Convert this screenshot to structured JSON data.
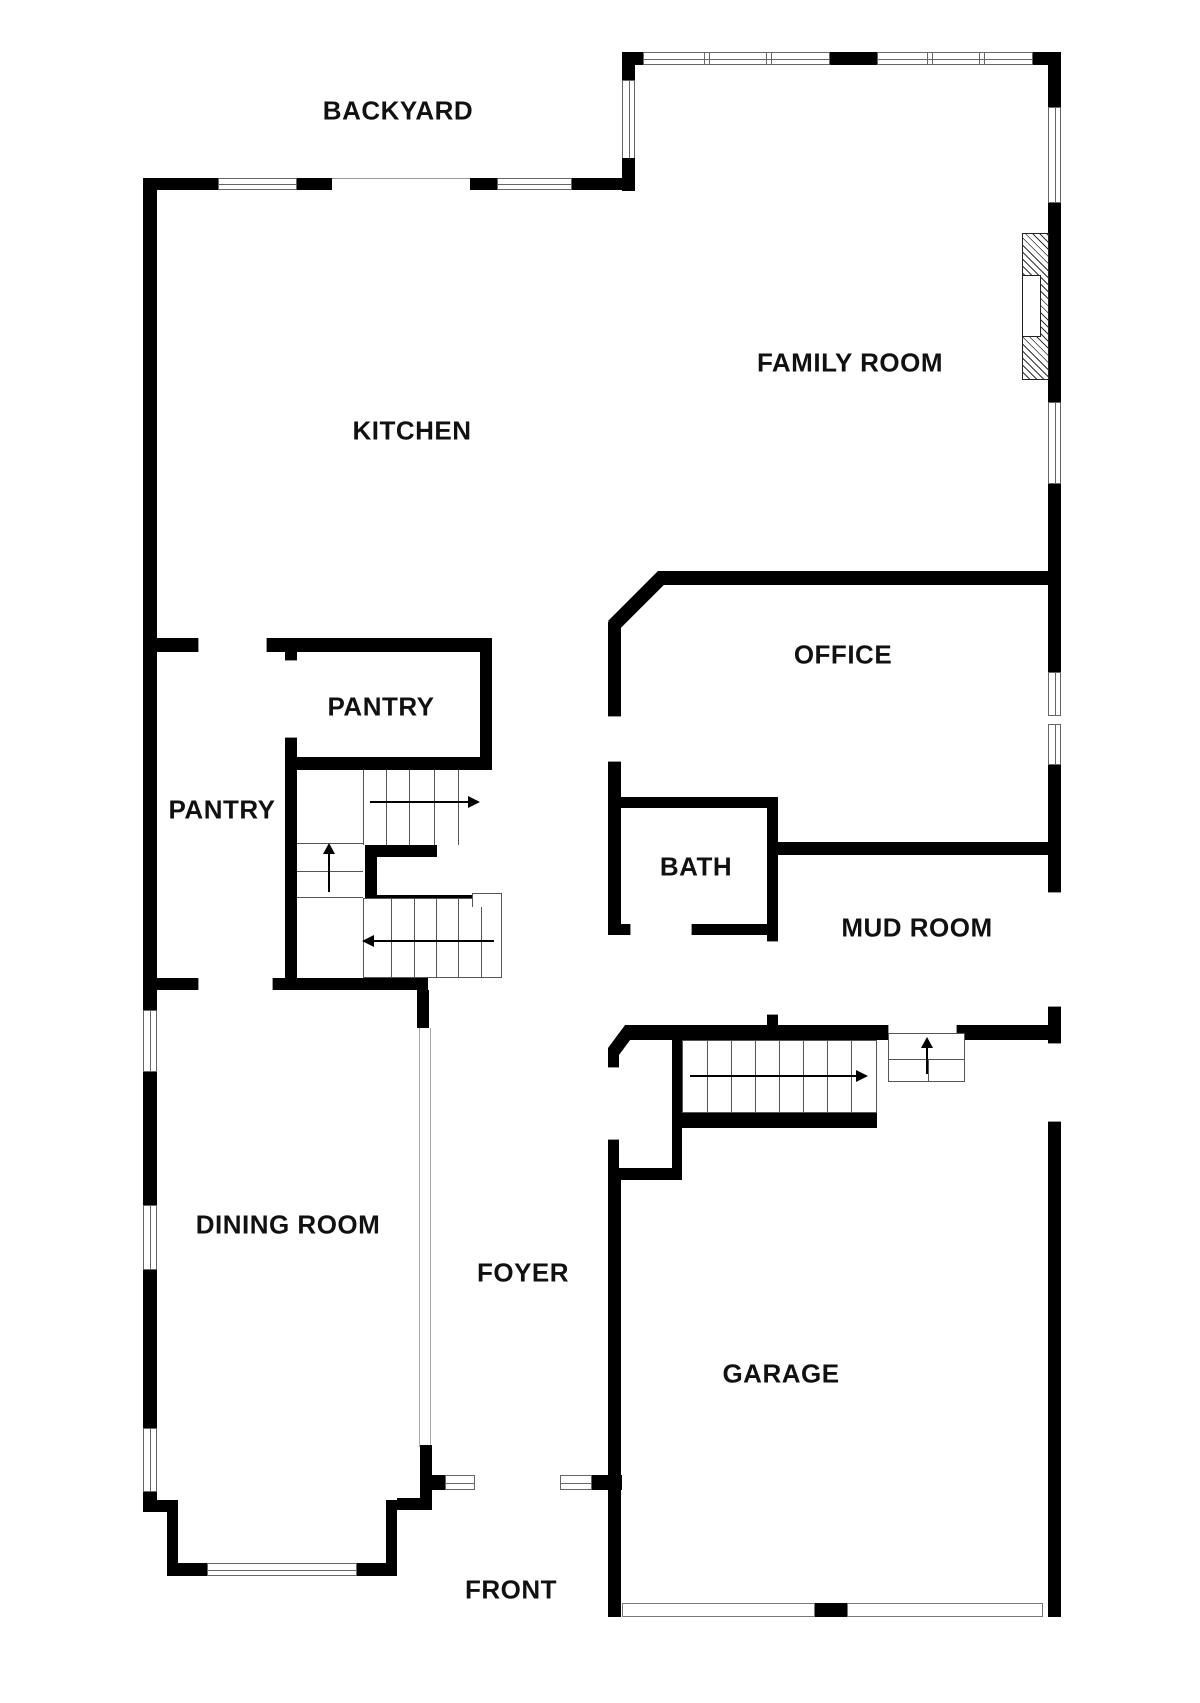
{
  "rooms": [
    {
      "key": "backyard",
      "label": "BACKYARD"
    },
    {
      "key": "family_room",
      "label": "FAMILY ROOM"
    },
    {
      "key": "kitchen",
      "label": "KITCHEN"
    },
    {
      "key": "office",
      "label": "OFFICE"
    },
    {
      "key": "pantry_upper",
      "label": "PANTRY"
    },
    {
      "key": "pantry_lower",
      "label": "PANTRY"
    },
    {
      "key": "bath",
      "label": "BATH"
    },
    {
      "key": "mud_room",
      "label": "MUD ROOM"
    },
    {
      "key": "dining_room",
      "label": "DINING ROOM"
    },
    {
      "key": "foyer",
      "label": "FOYER"
    },
    {
      "key": "garage",
      "label": "GARAGE"
    },
    {
      "key": "front",
      "label": "FRONT"
    }
  ],
  "colors": {
    "wall": "#000000",
    "thin_line": "#666666",
    "text": "#111111",
    "background": "#ffffff"
  }
}
